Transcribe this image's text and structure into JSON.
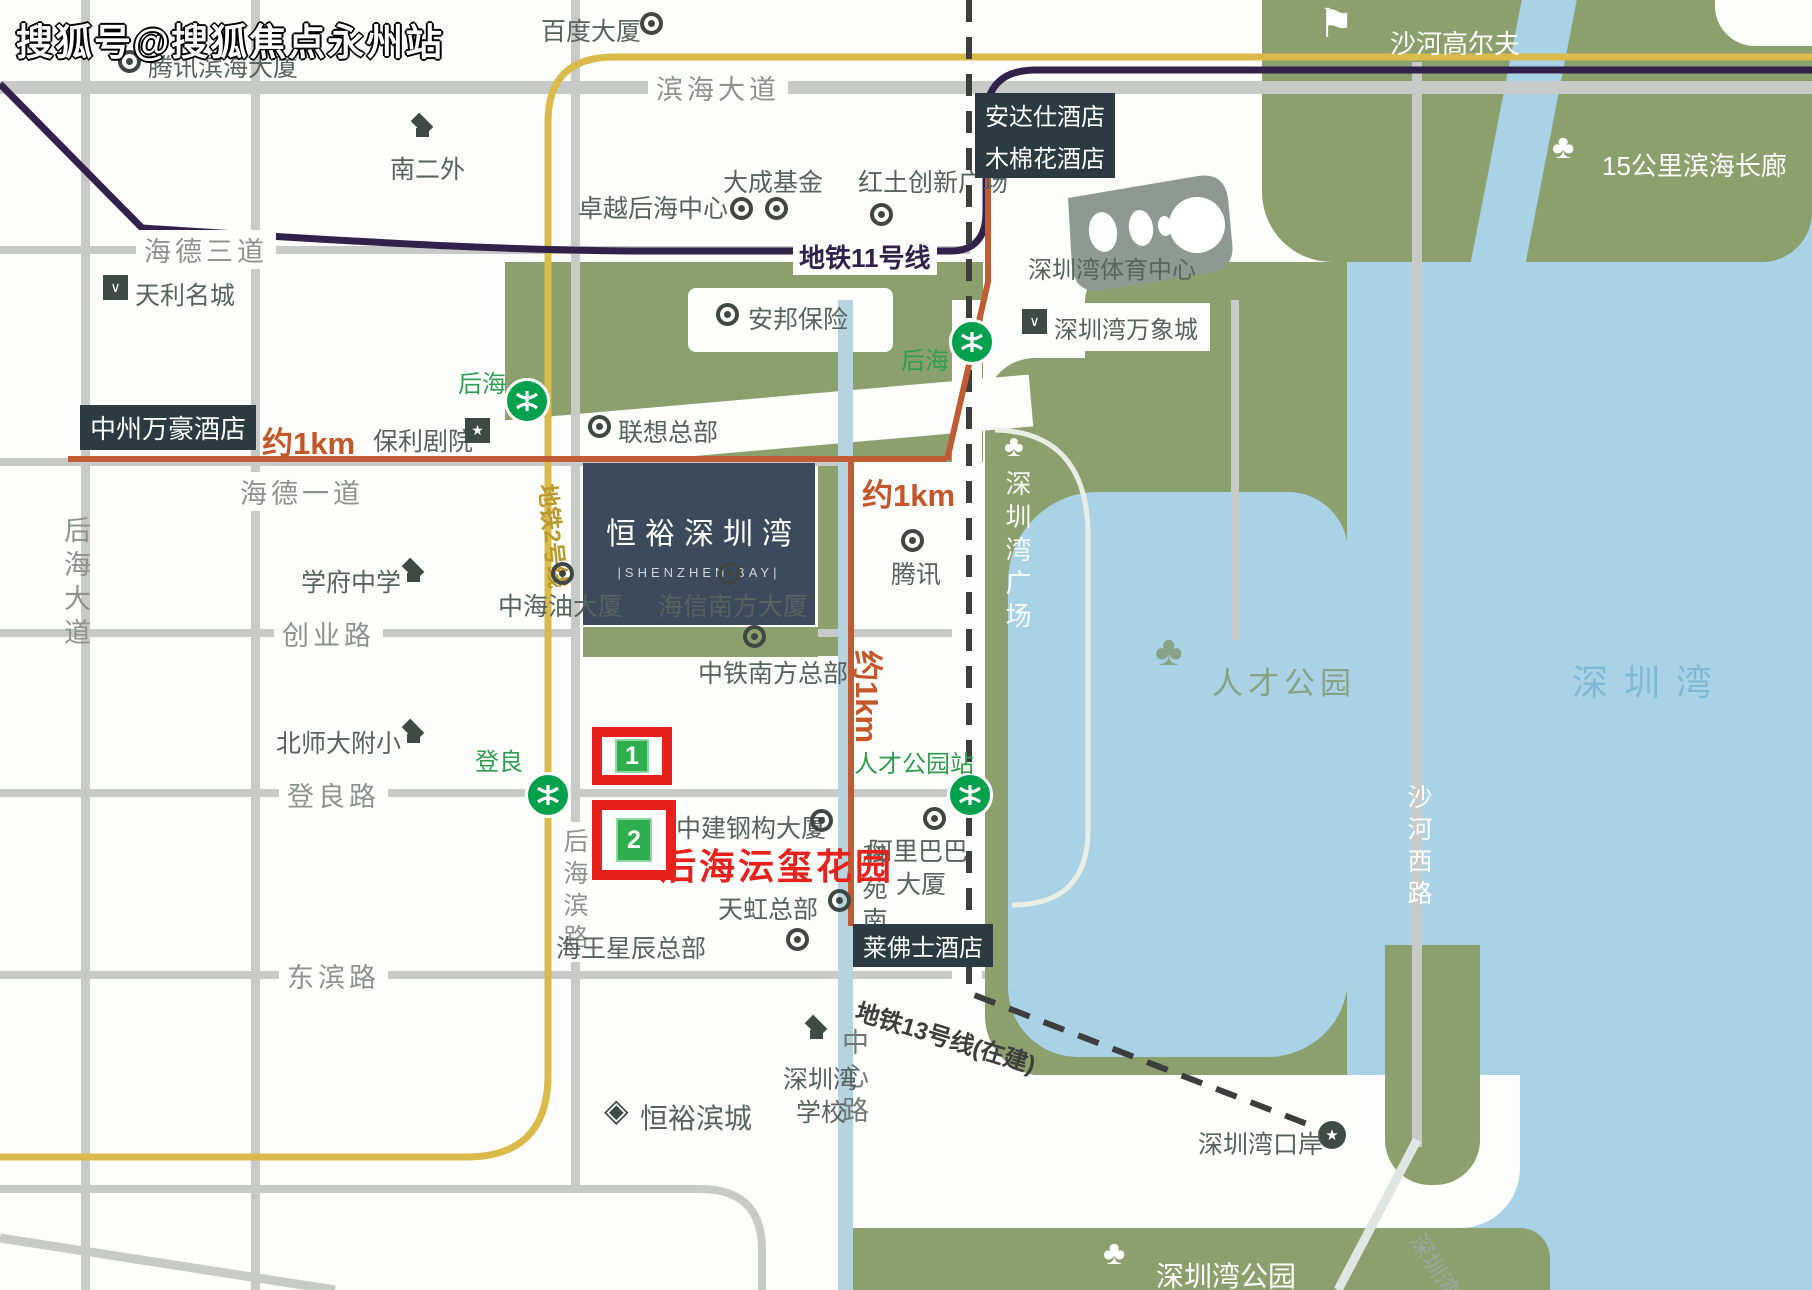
{
  "watermark": "搜狐号@搜狐焦点永州站",
  "project": {
    "name": "恒裕深圳湾",
    "name_en": "|SHENZHEN BAY|"
  },
  "metro": {
    "line11": "地铁11号线",
    "line2": "地铁2号线",
    "line13": "地铁13号线(在建)",
    "houhai": "后海",
    "dengliang": "登良",
    "rencai_station": "人才公园站"
  },
  "roads": {
    "binhai": "滨海大道",
    "haide3": "海德三道",
    "haide1": "海德一道",
    "chuangye": "创业路",
    "dengliang_rd": "登良路",
    "dongbin": "东滨路",
    "houhai_dadao": "后海大道",
    "houhai_bin": "后海滨路",
    "zhongxin": "中心路",
    "keyuan": "科苑南路",
    "shahe_xi": "沙河西路"
  },
  "distance": {
    "approx_1km": "约1km"
  },
  "landmarks": {
    "tencent_hq": "腾讯滨海大厦",
    "baidu": "百度大厦",
    "nan2wai": "南二外",
    "dacheng": "大成基金",
    "hongtu": "红土创新广场",
    "zhuoyue": "卓越后海中心",
    "andaz": "安达仕酒店",
    "cotton": "木棉花酒店",
    "golf": "沙河高尔夫",
    "corridor15km": "15公里滨海长廊",
    "sports_center": "深圳湾体育中心",
    "tianli": "天利名城",
    "anbang": "安邦保险",
    "mixc": "深圳湾万象城",
    "marriott": "中州万豪酒店",
    "poly_theatre": "保利剧院",
    "lenovo": "联想总部",
    "tencent": "腾讯",
    "szbay_plaza": "深圳湾广场",
    "xuefu": "学府中学",
    "cnooc": "中海油大厦",
    "hisense": "海信南方大厦",
    "crcc": "中铁南方总部",
    "bnu_primary": "北师大附小",
    "cscec": "中建钢构大厦",
    "yunxi_garden": "后海沄玺花园",
    "alibaba_line1": "阿里巴巴",
    "alibaba_line2": "大厦",
    "rainbow": "天虹总部",
    "neptunus": "海王星辰总部",
    "raffles": "莱佛士酒店",
    "talent_park": "人才公园",
    "shenzhen_bay": "深圳湾",
    "hengyu_bincheng": "恒裕滨城",
    "szbay_school_line1": "深圳湾",
    "szbay_school_line2": "学校",
    "szbay_port": "深圳湾口岸",
    "szbay_park": "深圳湾公园",
    "szbay_bridge": "深圳湾大桥"
  },
  "markers": {
    "plot1": "1",
    "plot2": "2"
  },
  "colors": {
    "land_green": "#8ca06e",
    "water_blue": "#a9d2e7",
    "metro2_yellow": "#d9ba4a",
    "metro11_purple": "#32214a",
    "metro13_dashed": "#3d3d3d",
    "route_orange": "#bf5b35",
    "highlight_red": "#e8211d",
    "station_green": "#00a04d",
    "badge_dark": "#2c3b42",
    "project_navy": "#3b4a5c"
  }
}
